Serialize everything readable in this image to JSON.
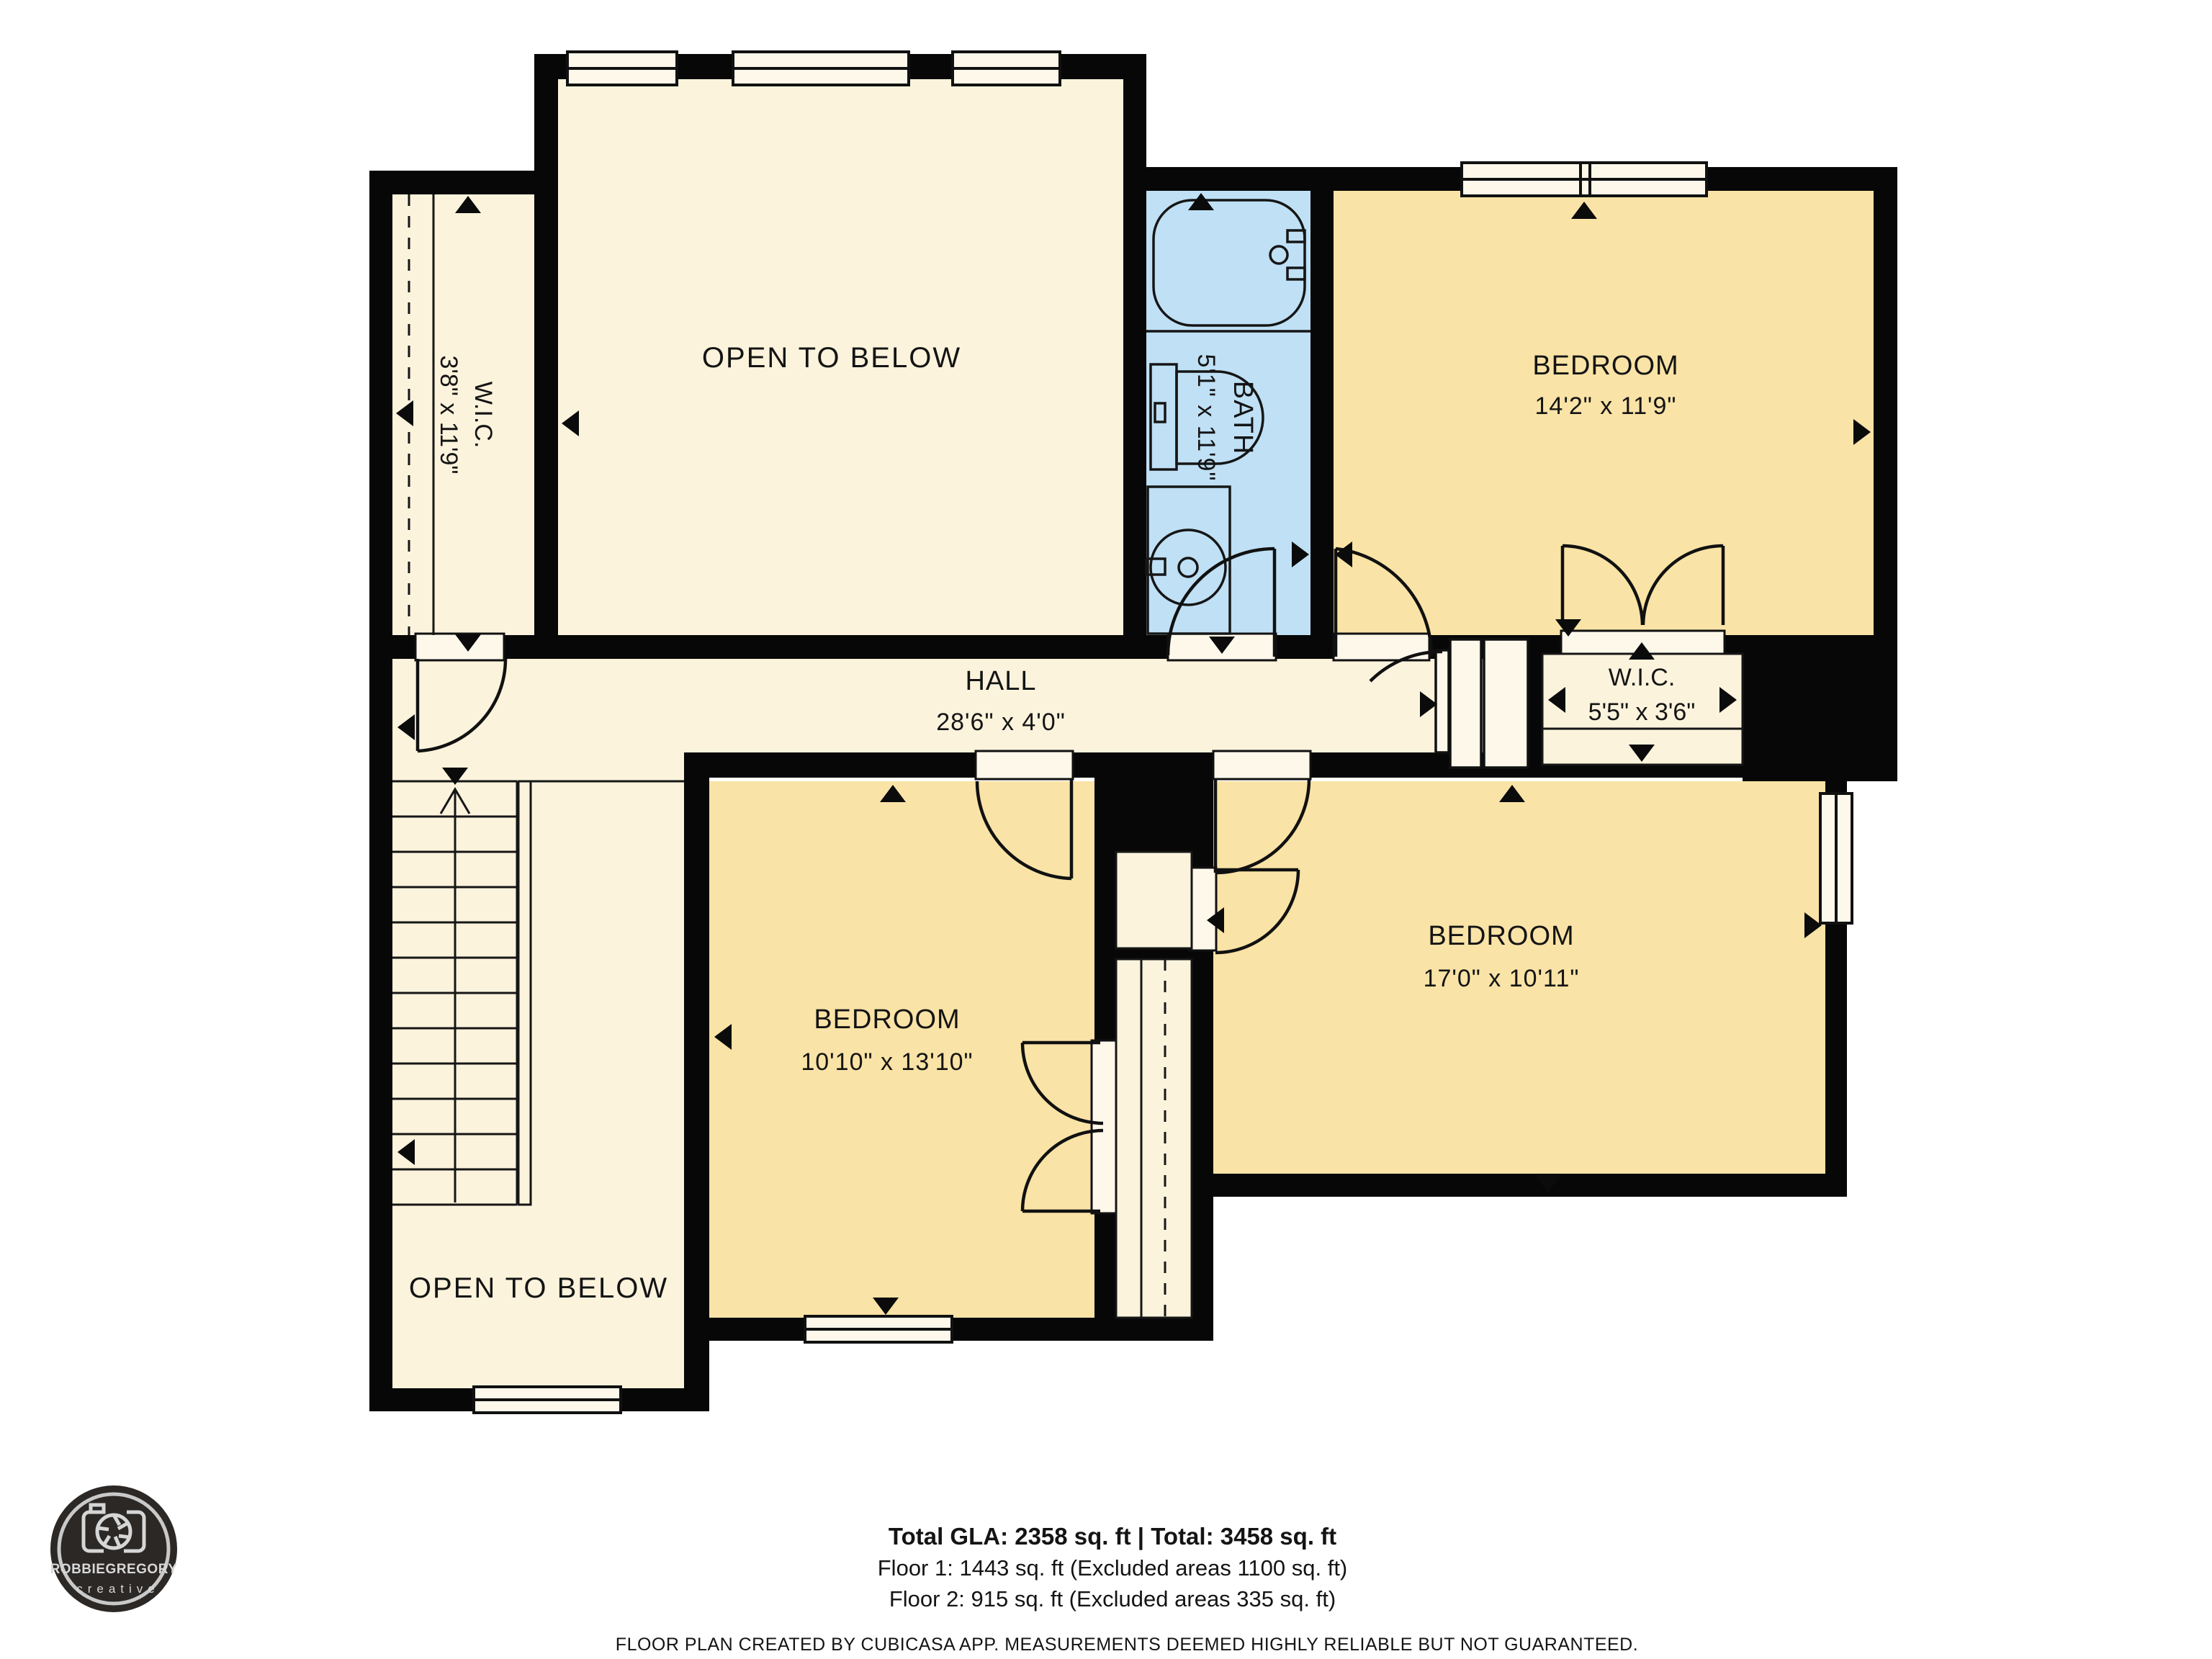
{
  "rooms": {
    "wic_top_left": {
      "name": "W.I.C.",
      "dims": "3'8\" x 11'9\""
    },
    "open_to_below_top": {
      "name": "OPEN TO BELOW"
    },
    "bath": {
      "name": "BATH",
      "dims": "5'1\" x 11'9\""
    },
    "bedroom_top_right": {
      "name": "BEDROOM",
      "dims": "14'2\" x 11'9\""
    },
    "hall": {
      "name": "HALL",
      "dims": "28'6\" x 4'0\""
    },
    "wic_bedroom": {
      "name": "W.I.C.",
      "dims": "5'5\" x 3'6\""
    },
    "bedroom_bottom_left": {
      "name": "BEDROOM",
      "dims": "10'10\" x 13'10\""
    },
    "bedroom_bottom_right": {
      "name": "BEDROOM",
      "dims": "17'0\" x 10'11\""
    },
    "open_to_below_bottom": {
      "name": "OPEN TO BELOW"
    }
  },
  "footer": {
    "total_line": "Total GLA: 2358 sq. ft | Total: 3458 sq. ft",
    "floor1_line": "Floor 1: 1443 sq. ft (Excluded areas 1100 sq. ft)",
    "floor2_line": "Floor 2: 915 sq. ft (Excluded areas 335 sq. ft)",
    "disclaimer": "FLOOR PLAN CREATED BY CUBICASA APP. MEASUREMENTS DEEMED HIGHLY RELIABLE BUT NOT GUARANTEED."
  },
  "logo": {
    "brand": "ROBBIEGREGORY",
    "sub": "creative"
  },
  "colors": {
    "floor_cream": "#FBF3DC",
    "bedroom_yellow": "#F9E3A6",
    "bath_blue": "#BFE0F5",
    "wall_black": "#070707",
    "sill_white": "#FDF8EA"
  }
}
